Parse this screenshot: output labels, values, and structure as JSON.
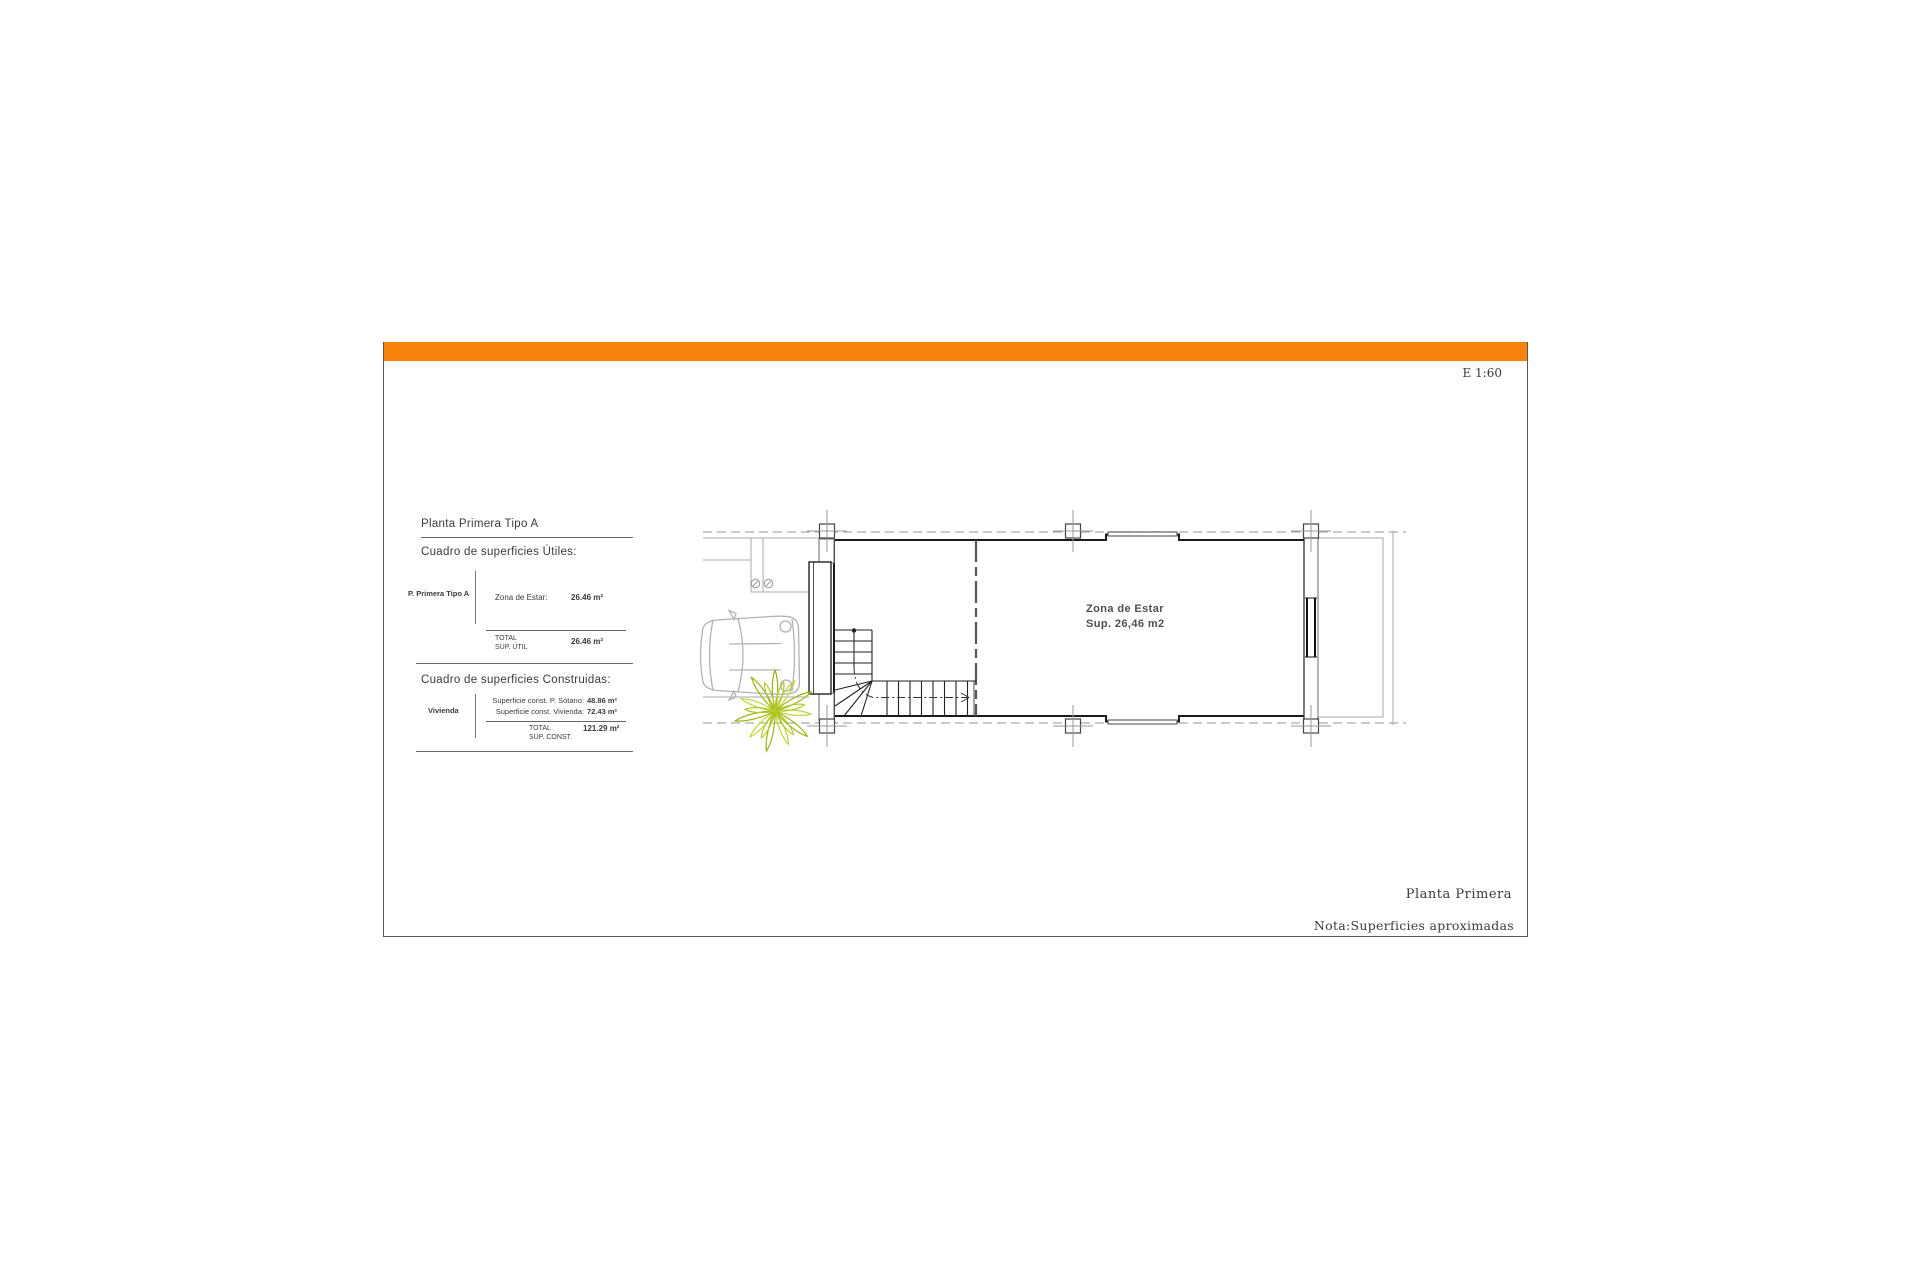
{
  "header": {
    "accent_color": "#F8820D",
    "scale_label": "E 1:60"
  },
  "surface_tables": {
    "title": "Planta Primera Tipo A",
    "utiles": {
      "heading": "Cuadro de superficies Útiles:",
      "group_label": "P. Primera Tipo A",
      "rows": [
        {
          "label": "Zona de Estar:",
          "value": "26.46 m²"
        }
      ],
      "total_line1": "TOTAL",
      "total_line2": "SUP. ÚTIL",
      "total_value": "26.46 m²"
    },
    "construidas": {
      "heading": "Cuadro de superficies Construidas:",
      "group_label": "Vivienda",
      "rows": [
        {
          "label": "Superficie const. P. Sótano:",
          "value": "48.86 m²"
        },
        {
          "label": "Superficie const. Vivienda:",
          "value": "72.43 m²"
        }
      ],
      "total_line1": "TOTAL",
      "total_line2": "SUP. CONST.",
      "total_value": "121.29 m²"
    }
  },
  "plan": {
    "room_label": "Zona de Estar",
    "room_area": "Sup. 26,46 m2",
    "plant_color": "#a9c11c"
  },
  "footer": {
    "plan_name": "Planta Primera",
    "note": "Nota:Superficies aproximadas"
  }
}
